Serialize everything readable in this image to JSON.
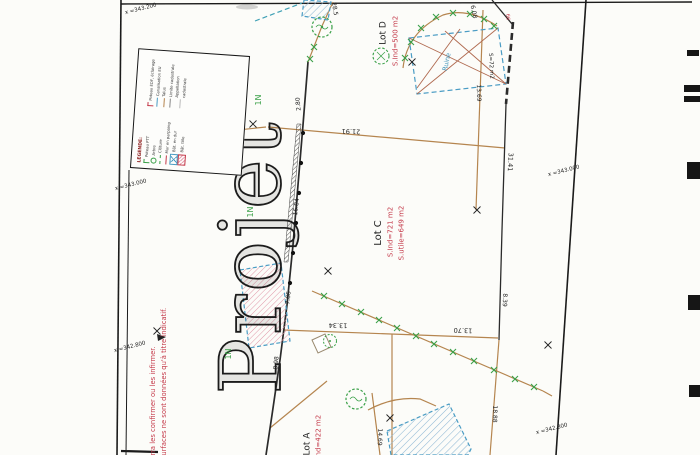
{
  "watermark": {
    "text": "Projet"
  },
  "lots": {
    "lot_d": {
      "name": "Lot D",
      "area": "S.Ind=500 m2"
    },
    "lot_c": {
      "name": "Lot C",
      "area_ind": "S.Ind=721 m2",
      "area_utile": "S.utile=649 m2"
    },
    "lot_a": {
      "name": "Lot A",
      "area": "S.Ind=422 m2"
    }
  },
  "ruin": {
    "label": "Ruine",
    "area": "S=72 m2"
  },
  "measurements": [
    {
      "text": "2.80"
    },
    {
      "text": "21.91"
    },
    {
      "text": "16.84"
    },
    {
      "text": "7.86"
    },
    {
      "text": "8.98"
    },
    {
      "text": "13.34"
    },
    {
      "text": "13.70"
    },
    {
      "text": "31.41"
    },
    {
      "text": "8.39"
    },
    {
      "text": "18.88"
    },
    {
      "text": "13.69"
    },
    {
      "text": "6.08"
    },
    {
      "text": "28.5"
    },
    {
      "text": "14.69"
    }
  ],
  "grid_labels": [
    {
      "text": "x =343.200"
    },
    {
      "text": "x =343.000"
    },
    {
      "text": "x =342.800"
    },
    {
      "text": "x =343.000"
    },
    {
      "text": "x =342.800"
    }
  ],
  "zone_labels": [
    {
      "text": "1N"
    },
    {
      "text": "1N"
    },
    {
      "text": "1N"
    }
  ],
  "disclaimer": {
    "line1": "ourra les confirmer ou les infirmer.",
    "line2": "t surfaces ne sont données qu'à titre indicatif."
  },
  "red_mark": {
    "text": "66"
  },
  "legend": {
    "title": "LEGENDE:",
    "col1": [
      {
        "symbol": "green-pole-icon",
        "label": "Poteau PTT"
      },
      {
        "symbol": "tree-icon",
        "label": "Arbre"
      },
      {
        "symbol": "green-dashed-line",
        "label": "Clôture"
      },
      {
        "symbol": "red-line",
        "label": "Mur en parpaing"
      }
    ],
    "col2": [
      {
        "symbol": "red-pole-icon",
        "label": "Poteau EDF, éclairage"
      },
      {
        "symbol": "blue-line",
        "label": "Canalisation EU"
      },
      {
        "symbol": "tan-line",
        "label": "Talus"
      },
      {
        "symbol": "gray-line",
        "label": "Limite cadastrale"
      },
      {
        "symbol": "thin-line",
        "label": "Appellation cadastrale"
      }
    ],
    "swatches": [
      {
        "symbol": "crossed-box-swatch",
        "label": "Bât. en dur"
      },
      {
        "symbol": "hatched-box-swatch",
        "label": "Bât. tôle"
      }
    ]
  },
  "colors": {
    "tan": "#b5854f",
    "green": "#3aa048",
    "red": "#c43a4a",
    "blue": "#4a9cc4",
    "ink": "#1f1f1f"
  }
}
